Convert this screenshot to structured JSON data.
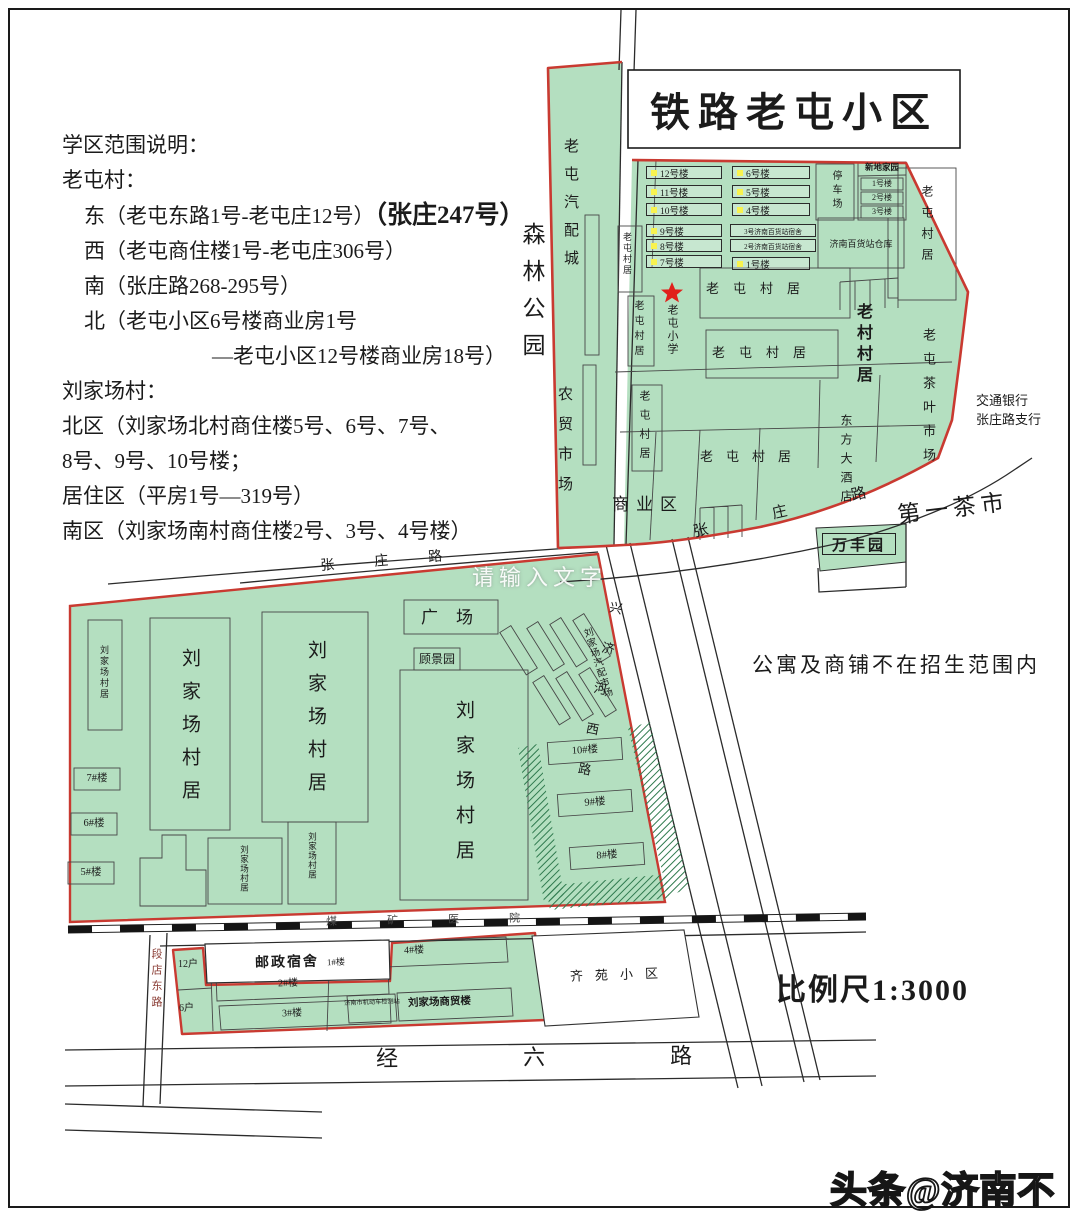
{
  "title": "铁路老屯小区",
  "description": {
    "heading": "学区范围说明：",
    "laotun_heading": "老屯村：",
    "east_main": "东（老屯东路1号-老屯庄12号）",
    "east_big": "（张庄247号）",
    "west": "西（老屯商住楼1号-老屯庄306号）",
    "south": "南（张庄路268-295号）",
    "north1": "北（老屯小区6号楼商业房1号",
    "north2": "—老屯小区12号楼商业房18号）",
    "liujiachang_heading": "刘家场村：",
    "north_area1": "北区（刘家场北村商住楼5号、6号、7号、",
    "north_area2": "8号、9号、10号楼；",
    "residential": "居住区（平房1号—319号）",
    "south_area": "南区（刘家场南村商住楼2号、3号、4号楼）"
  },
  "labels": {
    "forest_park": "森林公园",
    "auto_parts_city": "老屯汽配城",
    "farmers_market": "农贸市场",
    "parking": "停车场",
    "xindi_name": "新地家园",
    "xindi_rows": [
      "1号楼",
      "2号楼",
      "3号楼"
    ],
    "warehouse": "济南百货站仓库",
    "laotun_village": "老屯村居",
    "old_village": "老村村居",
    "tea_market": "老屯茶叶市场",
    "bank1": "交通银行",
    "bank2": "张庄路支行",
    "school": "老屯小学",
    "hotel": "东方大酒店",
    "commercial": "商业区",
    "tea_city": "第一茶市",
    "wanfengyuan": "万丰园",
    "plaza": "广场",
    "gujingyuan": "顾景园",
    "liujiachang_village": "刘家场村居",
    "liujia_auto_market": "刘家场汽配市场",
    "trade_building": "刘家场商贸楼",
    "office_small": "济南市机动车检测站",
    "postal_dorm": "邮政宿舍",
    "postal_no": "1#楼",
    "qiyuan": "齐苑小区",
    "hospital": "煤矿医院",
    "note": "公寓及商铺不在招生范围内",
    "scale": "比例尺1:3000"
  },
  "buildings": {
    "upper_left": [
      "12号楼",
      "11号楼",
      "10号楼",
      "9号楼",
      "8号楼",
      "7号楼"
    ],
    "upper_right": [
      "6号楼",
      "5号楼",
      "4号楼"
    ],
    "dorm3": "3号济南百货站宿舍",
    "dorm2": "2号济南百货站宿舍",
    "no1": "1号楼",
    "lower": {
      "b10": "10#楼",
      "b9": "9#楼",
      "b8": "8#楼",
      "b7": "7#楼",
      "b6": "6#楼",
      "b5": "5#楼"
    },
    "strip": {
      "b2": "2#楼",
      "b3": "3#楼",
      "b4": "4#楼",
      "u12": "12户",
      "u6": "6户"
    }
  },
  "roads": {
    "zhangzhuang": "张庄路",
    "xingjihe": "兴济河西路",
    "jingliu": "经六路",
    "duandian": "段店东路"
  },
  "watermarks": {
    "center": "请输入文字",
    "corner": "头条@济南不凡事"
  },
  "colors": {
    "district_green": "#b4dfc0",
    "boundary_red": "#c93a31",
    "dot_yellow": "#f8f34f"
  }
}
